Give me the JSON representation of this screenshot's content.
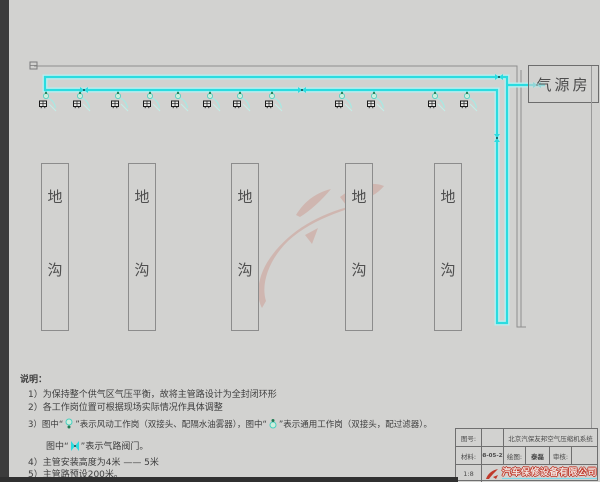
{
  "drawing": {
    "air_source_room_label": "气源房",
    "trench_chars": [
      "地",
      "沟"
    ],
    "trench_count": 5,
    "workstation_pairs": 6,
    "pipe_color": "#2bdce0",
    "pipe_glow_color": "#b8efef",
    "watermark_color": "#c96a58",
    "building_line_color": "#8e8e8e",
    "icons": {
      "pneumatic_station": "pneumatic-workstation-icon",
      "general_station": "general-workstation-icon",
      "valve": "air-line-valve-icon",
      "flange": "pipe-flange-icon",
      "logo": "red-dragon-logo-icon"
    }
  },
  "notes": {
    "heading": "说明：",
    "n1": "1）为保持整个供气区气压平衡，故将主管路设计为全封闭环形",
    "n2": "2）各工作岗位置可根据现场实际情况作具体调整",
    "n3_p1": "3）图中“",
    "n3_p2": "”表示风动工作岗（双接头、配隔水油雾器），图中“",
    "n3_p3": "”表示通用工作岗（双接头，配过滤器）。",
    "n3b_p1": "图中“",
    "n3b_p2": "”表示气路阀门。",
    "n4": "4）主管安装高度为4米 —— 5米",
    "n5": "5）主管路预设200米。"
  },
  "title_block": {
    "drawing_no_label": "图号:",
    "drawing_no_value": "",
    "title": "北京汽保友邦空气压缩机系统",
    "material_label": "材料:",
    "date": "08-05-22",
    "drawn_label": "绘图:",
    "drawn_by": "泰磊",
    "checked_label": "审核:",
    "checked_by": "",
    "scale": "1:8",
    "logo_text": "汽车保修设备有限公司"
  }
}
